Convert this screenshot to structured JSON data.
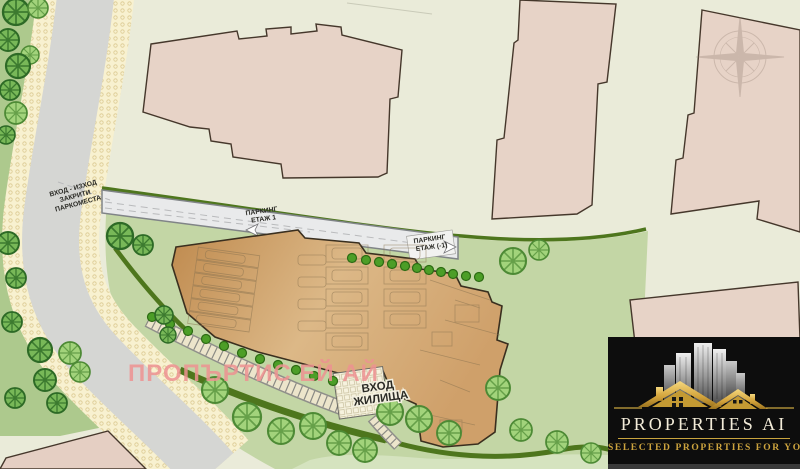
{
  "plan": {
    "street_label": {
      "l1": "ВХОД - ИЗХОД",
      "l2": "ЗАКРИТИ",
      "l3": "ПАРКОМЕСТА"
    },
    "parking1": {
      "l1": "ПАРКИНГ",
      "l2": "ЕТАЖ 1"
    },
    "parkingm1": {
      "l1": "ПАРКИНГ",
      "l2": "ЕТАЖ (-1)"
    },
    "entrance": {
      "l1": "ВХОД",
      "l2": "ЖИЛИЩА"
    },
    "watermark": "ПРОПЪРТИС ЕЙ АЙ"
  },
  "logo": {
    "brand": "PROPERTIES AI",
    "tagline": "SELECTED PROPERTIES FOR YOU"
  },
  "colors": {
    "background": "#eaebd9",
    "site_lawn": "#c3d6a5",
    "roadside_green": "#adc98d",
    "road": "#d5d6d3",
    "sidewalk": "#f8f1d0",
    "neighbor_building": "#e7d3c7",
    "main_building": "#d3a874",
    "hedge": "#4e761d",
    "tree_dark": "#78b858",
    "tree_light": "#a2d37b",
    "watermark_pink": "#ee9292",
    "logo_background": "#0d0d0d",
    "logo_gold": "#c9a53f",
    "logo_text": "#f3ecd9"
  }
}
